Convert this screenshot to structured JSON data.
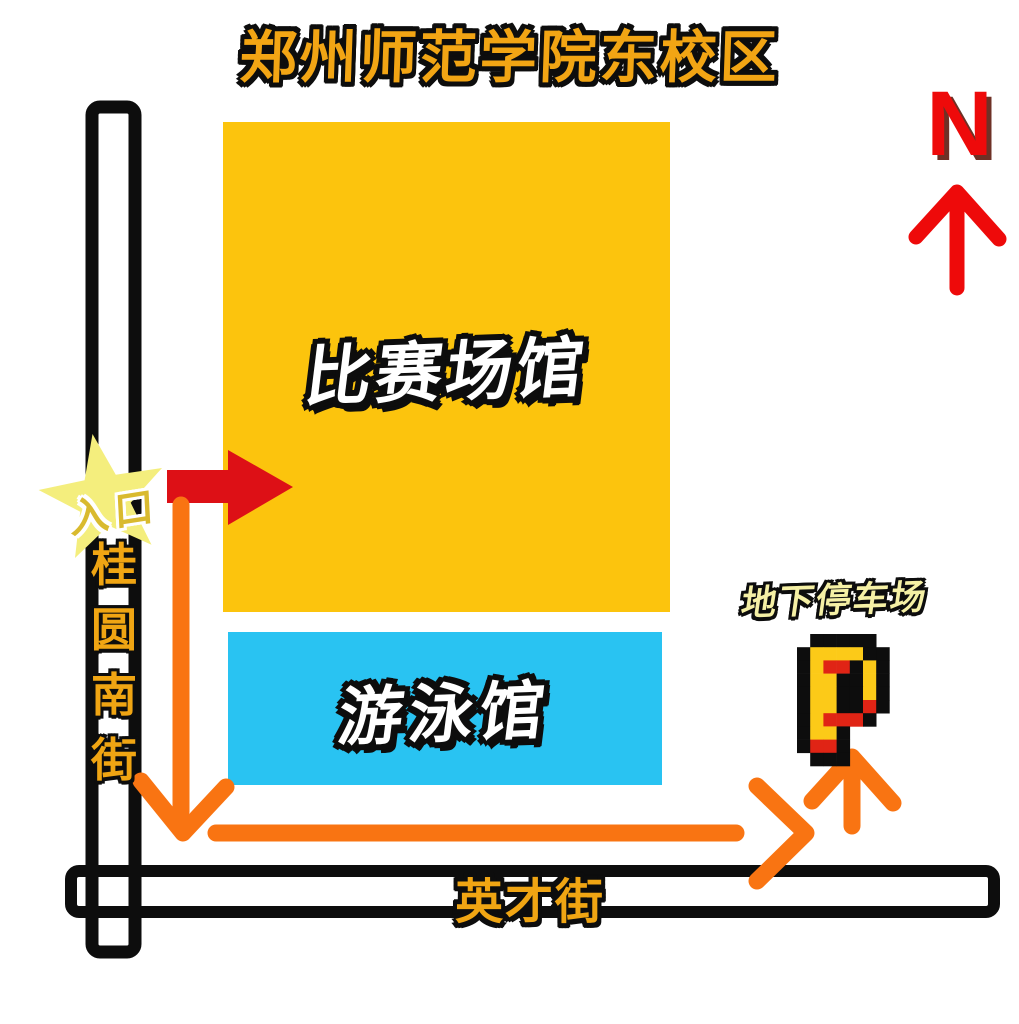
{
  "title": "郑州师范学院东校区",
  "compass": {
    "letter": "N"
  },
  "buildings": {
    "arena": {
      "label": "比赛场馆"
    },
    "pool": {
      "label": "游泳馆"
    }
  },
  "roads": {
    "vertical_street": {
      "name": "桂圆南街",
      "chars": [
        "桂",
        "圆",
        "南",
        "街"
      ]
    },
    "horizontal_street": {
      "name": "英才街"
    }
  },
  "entrance": {
    "label": "入口"
  },
  "parking": {
    "label": "地下停车场",
    "pixel_icon": {
      "palette": {
        "K": "#0d0d0d",
        "Y": "#fcca18",
        "R": "#e02415",
        ".": "none"
      },
      "rows": [
        ".KKKKK.",
        "KYYYYKK",
        "KYRRKYK",
        "KYYKKYK",
        "KYYKKYK",
        "KYYKKRK",
        "KYRRRK.",
        "KYYK...",
        "KRRK...",
        ".KKK..."
      ]
    }
  },
  "colors": {
    "title_gold": "#f2a514",
    "street_gold": "#f0a513",
    "arena_yellow": "#fcc40d",
    "pool_blue": "#29c3f2",
    "road_black": "#0d0d0d",
    "route_orange": "#f97412",
    "entry_red": "#dd1016",
    "north_red": "#ee0a0a",
    "star_yellow": "#f4ee7d",
    "entrance_gold": "#d9ba2e",
    "parking_cream": "#f5f0a5"
  }
}
